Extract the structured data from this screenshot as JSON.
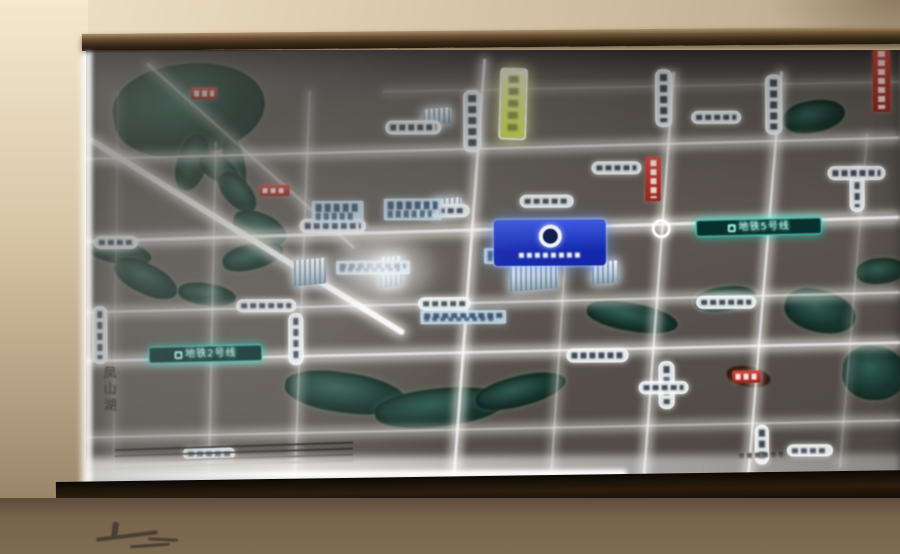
{
  "display": {
    "metro_badge_left": "地铁2号线",
    "metro_badge_right": "地铁5号线",
    "lake_name_left": "凤山湖"
  },
  "palette": {
    "wall": "#d8c9ac",
    "frame": "#3a2a18",
    "map_background": "#55504a",
    "road_glow": "#ffffff",
    "water": "#1d4438",
    "metro_teal": "#00e5c8",
    "project_badge_blue": "#1e3ad8",
    "highway_badge_yellow": "#e3ef6a",
    "poi_red": "#c23425"
  },
  "map": {
    "roads_h": [
      [
        0,
        96,
        814,
        5,
        -1.2,
        0.85
      ],
      [
        298,
        36,
        516,
        3,
        -0.8,
        0.4
      ],
      [
        0,
        176,
        814,
        7,
        -1.4,
        1
      ],
      [
        0,
        250,
        814,
        5,
        -1.1,
        0.8
      ],
      [
        0,
        299,
        814,
        6,
        -1.0,
        0.95
      ],
      [
        0,
        377,
        814,
        4,
        -0.9,
        0.7
      ]
    ],
    "roads_v": [
      [
        28,
        40,
        3,
        400,
        1,
        0.3
      ],
      [
        124,
        90,
        4,
        350,
        1.5,
        0.5
      ],
      [
        214,
        40,
        4,
        400,
        2.5,
        0.55
      ],
      [
        380,
        8,
        6,
        432,
        4.5,
        1
      ],
      [
        470,
        190,
        4,
        250,
        4,
        0.6
      ],
      [
        570,
        22,
        5,
        418,
        4.5,
        0.9
      ],
      [
        676,
        22,
        5,
        418,
        5,
        0.95
      ],
      [
        766,
        85,
        3,
        335,
        5,
        0.4
      ]
    ],
    "diagonals": [
      [
        4,
        84,
        370,
        6,
        32,
        0.95
      ],
      [
        62,
        10,
        278,
        3,
        42,
        0.5
      ]
    ],
    "waters": [
      [
        28,
        12,
        152,
        92,
        -8,
        1
      ],
      [
        92,
        82,
        30,
        58,
        18,
        1
      ],
      [
        138,
        84,
        22,
        62,
        -8,
        1
      ],
      [
        112,
        106,
        44,
        24,
        32,
        1
      ],
      [
        128,
        128,
        48,
        26,
        48,
        1
      ],
      [
        146,
        162,
        56,
        30,
        22,
        1
      ],
      [
        136,
        192,
        62,
        26,
        -14,
        1
      ],
      [
        0,
        188,
        66,
        24,
        12,
        1
      ],
      [
        26,
        212,
        68,
        30,
        26,
        1
      ],
      [
        92,
        232,
        58,
        22,
        8,
        1
      ],
      [
        198,
        322,
        122,
        40,
        8,
        1
      ],
      [
        288,
        338,
        132,
        38,
        -6,
        1
      ],
      [
        388,
        326,
        92,
        30,
        -14,
        1
      ],
      [
        500,
        254,
        92,
        28,
        10,
        1
      ],
      [
        608,
        238,
        62,
        24,
        -8,
        1
      ],
      [
        698,
        242,
        72,
        42,
        14,
        1
      ],
      [
        756,
        298,
        64,
        54,
        4,
        1
      ],
      [
        698,
        52,
        62,
        32,
        -10,
        1
      ],
      [
        770,
        210,
        50,
        26,
        -6,
        0.9
      ]
    ],
    "dark_blobs": [
      [
        640,
        318,
        44,
        20,
        10,
        1
      ]
    ],
    "buildings": [
      [
        208,
        208,
        32,
        26
      ],
      [
        294,
        206,
        22,
        30
      ],
      [
        424,
        214,
        48,
        26
      ],
      [
        348,
        148,
        28,
        18
      ],
      [
        338,
        58,
        28,
        16
      ],
      [
        506,
        212,
        26,
        22
      ]
    ],
    "pills_v": [
      [
        6,
        254,
        13,
        56
      ],
      [
        202,
        262,
        13,
        50
      ],
      [
        378,
        40,
        16,
        60
      ],
      [
        570,
        20,
        15,
        56
      ],
      [
        680,
        26,
        15,
        58
      ],
      [
        572,
        312,
        14,
        46
      ],
      [
        668,
        376,
        12,
        38
      ],
      [
        764,
        118,
        13,
        44
      ]
    ],
    "pills_h": [
      [
        8,
        184,
        42,
        11
      ],
      [
        214,
        168,
        64,
        12
      ],
      [
        330,
        154,
        52,
        11
      ],
      [
        434,
        145,
        52,
        11
      ],
      [
        506,
        112,
        48,
        11
      ],
      [
        742,
        118,
        56,
        12
      ],
      [
        300,
        70,
        54,
        12
      ],
      [
        150,
        248,
        58,
        11
      ],
      [
        332,
        247,
        50,
        11
      ],
      [
        610,
        247,
        58,
        11
      ],
      [
        480,
        299,
        60,
        12
      ],
      [
        552,
        332,
        48,
        11
      ],
      [
        96,
        396,
        50,
        10
      ],
      [
        700,
        396,
        44,
        10
      ],
      [
        606,
        62,
        48,
        11
      ]
    ],
    "red_v": [
      [
        560,
        108,
        15,
        44
      ],
      [
        788,
        0,
        17,
        64
      ]
    ],
    "red_h": [
      [
        106,
        36,
        26,
        12
      ],
      [
        174,
        134,
        30,
        11
      ],
      [
        646,
        322,
        28,
        12
      ]
    ],
    "info_boxes": [
      [
        226,
        150,
        52,
        22
      ],
      [
        298,
        148,
        58,
        22
      ],
      [
        398,
        198,
        66,
        16
      ],
      [
        250,
        210,
        74,
        14
      ],
      [
        334,
        260,
        86,
        14
      ]
    ],
    "scale_lines": [
      [
        28,
        394,
        238,
        2
      ],
      [
        28,
        400,
        238,
        2
      ],
      [
        28,
        406,
        238,
        2
      ],
      [
        28,
        412,
        238,
        2
      ]
    ],
    "dark_marks": [
      [
        652,
        404,
        44,
        5,
        -2,
        1
      ]
    ],
    "wall_strokes": [
      [
        96,
        534,
        62,
        4,
        -7,
        1
      ],
      [
        112,
        522,
        6,
        16,
        8,
        1
      ],
      [
        148,
        538,
        30,
        3,
        3,
        1
      ],
      [
        130,
        544,
        40,
        3,
        -4,
        1
      ]
    ]
  }
}
